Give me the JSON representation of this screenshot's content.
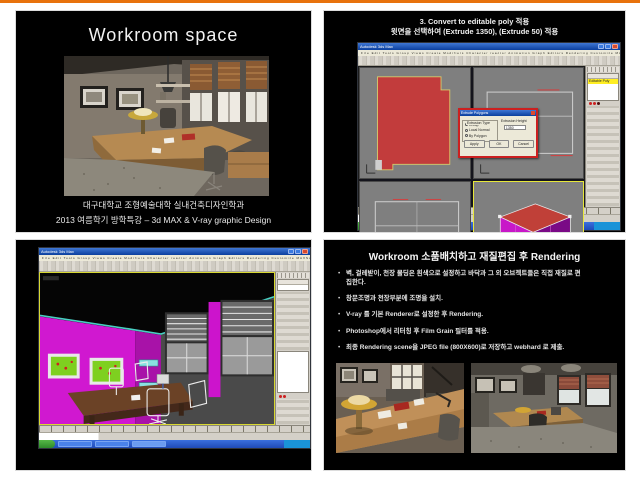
{
  "frame": {
    "accent_color": "#e8720c",
    "slide_background": "#000000"
  },
  "slides": {
    "workroom_space": {
      "title": "Workroom space",
      "caption_line1": "대구대학교 조형예술대학 실내건축디자인학과",
      "caption_line2": "2013 여름학기 방학특강 – 3d MAX & V-ray graphic Design"
    },
    "editable_poly": {
      "title_line1": "3. Convert to editable poly 적용",
      "title_line2": "윗면을 선택하여 (Extrude 1350), (Extrude 50) 적용",
      "window_title": "Autodesk 3ds Max",
      "menu_bar": "File Edit Tools Group Views Create Modifiers Character reactor Animation Graph Editors Rendering Customize MAXScript Help",
      "modifier_stack_item": "Editable Poly",
      "dialog": {
        "title": "Extrude Polygons",
        "type_group_label": "Extrusion Type",
        "options": [
          "Group",
          "Local Normal",
          "By Polygon"
        ],
        "height_label": "Extrusion Height",
        "height_value": "1350",
        "apply_label": "Apply",
        "ok_label": "OK",
        "cancel_label": "Cancel"
      }
    },
    "model_view": {
      "window_title": "Autodesk 3ds Max",
      "menu_bar": "File Edit Tools Group Views Create Modifiers Character reactor Animation Graph Editors Rendering Customize MAXScript Help",
      "modifier_stack_item": "Modifier List"
    },
    "rendering": {
      "title": "Workroom  소품배치하고 재질편집 후 Rendering",
      "bullets": [
        "벽, 걸레받이, 천장 몰딩은 흰색으로 설정하고 바닥과 그 외 오브젝트들은 직접 재질로 편집한다.",
        "창문조명과 천장부분에 조명을 설치.",
        "V-ray 를 기본 Renderer로 설정한 후 Rendering.",
        "Photoshop에서 리터칭 후  Film Grain 필터를 적용.",
        "최종 Rendering  scene을  JPEG file (800X600)로 저장하고  webhard 로 제출."
      ]
    }
  }
}
